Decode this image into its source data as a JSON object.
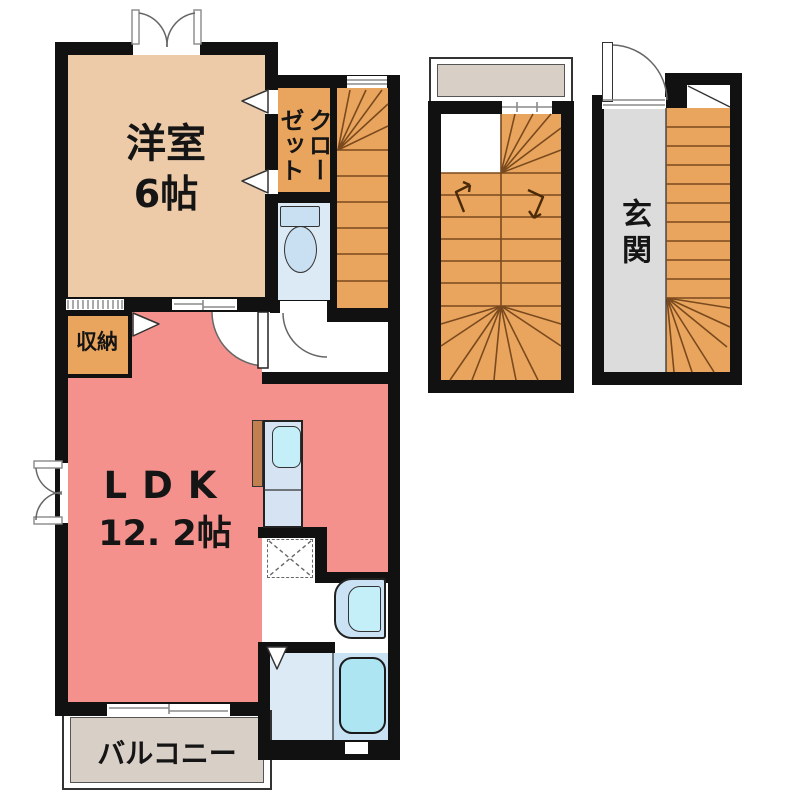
{
  "rooms": {
    "western_room": {
      "name": "洋室",
      "size": "6帖"
    },
    "closet": {
      "label": "クローゼット"
    },
    "storage": {
      "label": "収納"
    },
    "ldk": {
      "name": "LDK",
      "size": "12. 2帖"
    },
    "balcony": {
      "label": "バルコニー"
    },
    "entrance": {
      "label": "玄関"
    }
  },
  "colors": {
    "wall": "#111111",
    "western_room": "#EDCBA8",
    "orange": "#E9A55D",
    "ldk": "#F5918C",
    "water_floor": "#DCEAF6",
    "fixture_blue": "#C9DFF2",
    "tub_cyan": "#AEE5F2",
    "balcony_gray": "#D8CFC7",
    "entrance_gray": "#DCDCDC",
    "stair_line": "#7A4A1E",
    "counter_blue": "#D5E3F2",
    "sink_cyan": "#C5EFF8",
    "stove_brown": "#C28050"
  }
}
